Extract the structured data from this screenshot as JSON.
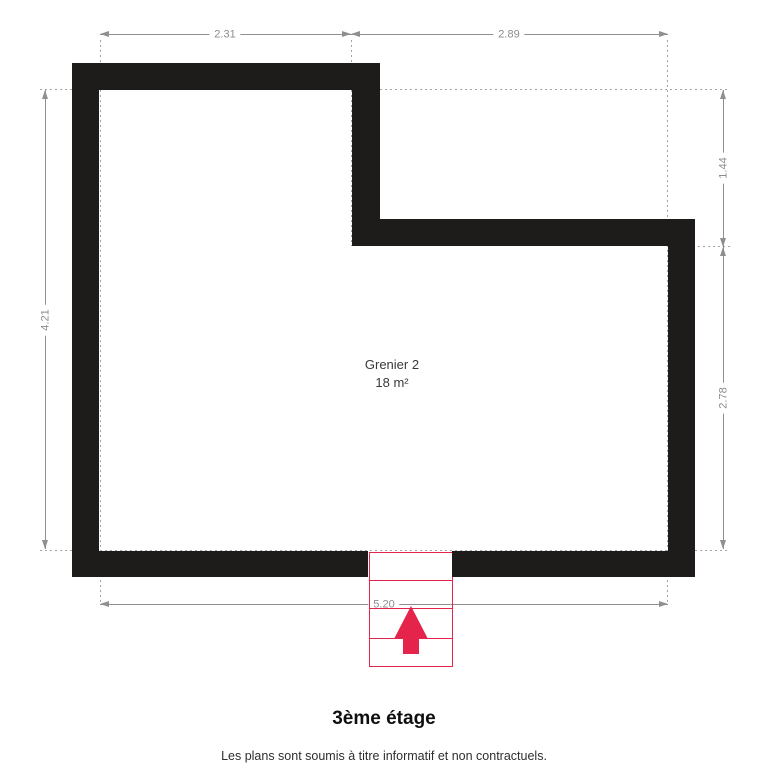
{
  "title": "3ème étage",
  "footer": "Les plans sont soumis à titre informatif et non contractuels.",
  "room": {
    "name": "Grenier 2",
    "area": "18 m²"
  },
  "dimensions": {
    "top_left": "2.31",
    "top_right": "2.89",
    "left": "4.21",
    "right_upper": "1.44",
    "right_lower": "2.78",
    "bottom": "5.20"
  },
  "stairs": {
    "icon": "up-arrow",
    "direction": "up"
  },
  "colors": {
    "wall": "#1e1c1a",
    "dimension_lines": "#8f8f8f",
    "dimension_text": "#8c8c8c",
    "extension_lines": "#a3a3a3",
    "stairs": "#e4244a",
    "background": "#ffffff"
  }
}
